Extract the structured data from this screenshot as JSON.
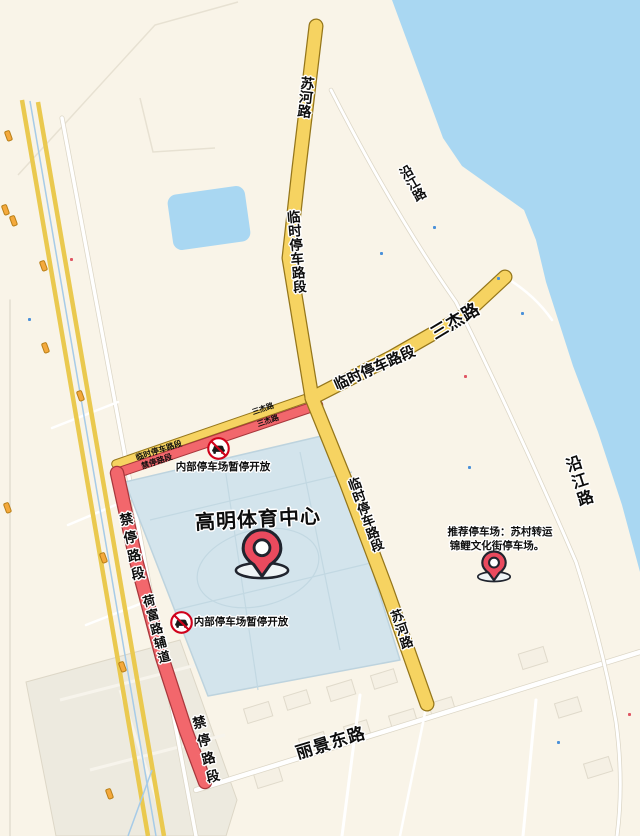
{
  "colors": {
    "map_background": "#f9f4e8",
    "water": "#a9d7f2",
    "venue_area": "#d3e4ec",
    "temporary_parking_road": "#f6d361",
    "no_parking_road": "#f2676c",
    "minor_road_yellow": "#eac94f",
    "pin_red": "#ea4a5e",
    "prohibition_sign_red": "#d0021b"
  },
  "venue": {
    "name": "高明体育中心"
  },
  "markers": {
    "venue_pin": {
      "icon": "location-pin-icon"
    },
    "recommended_parking_pin": {
      "icon": "location-pin-icon"
    },
    "closed_parking_sign_north": {
      "icon": "no-parking-car-icon",
      "label": "内部停车场暂停开放"
    },
    "closed_parking_sign_west": {
      "icon": "no-parking-car-icon",
      "label": "内部停车场暂停开放"
    },
    "recommended_parking": {
      "line1": "推荐停车场：苏村转运",
      "line2": "锦鲤文化街停车场。"
    }
  },
  "road_labels": {
    "suhe_road_north": "苏河路",
    "temp_parking_section_north": "临时停车路段",
    "sanjie_road": "三杰路",
    "temp_parking_section_middle": "临时停车路段",
    "temp_parking_section_south": "临时停车路段",
    "suhe_road_south": "苏河路",
    "yanjiang_road_north": "沿江路",
    "yanjiang_road_east": "沿江路",
    "no_parking_section_upper": "禁停路段",
    "hefu_service_road": "荷富路辅道",
    "no_parking_section_lower": "禁停路段",
    "lijing_east_road": "丽景东路",
    "sanjie_road_small_1": "三杰路",
    "sanjie_road_small_2": "三杰路",
    "temp_parking_small": "临时停车路段",
    "no_parking_small": "禁停路段"
  }
}
